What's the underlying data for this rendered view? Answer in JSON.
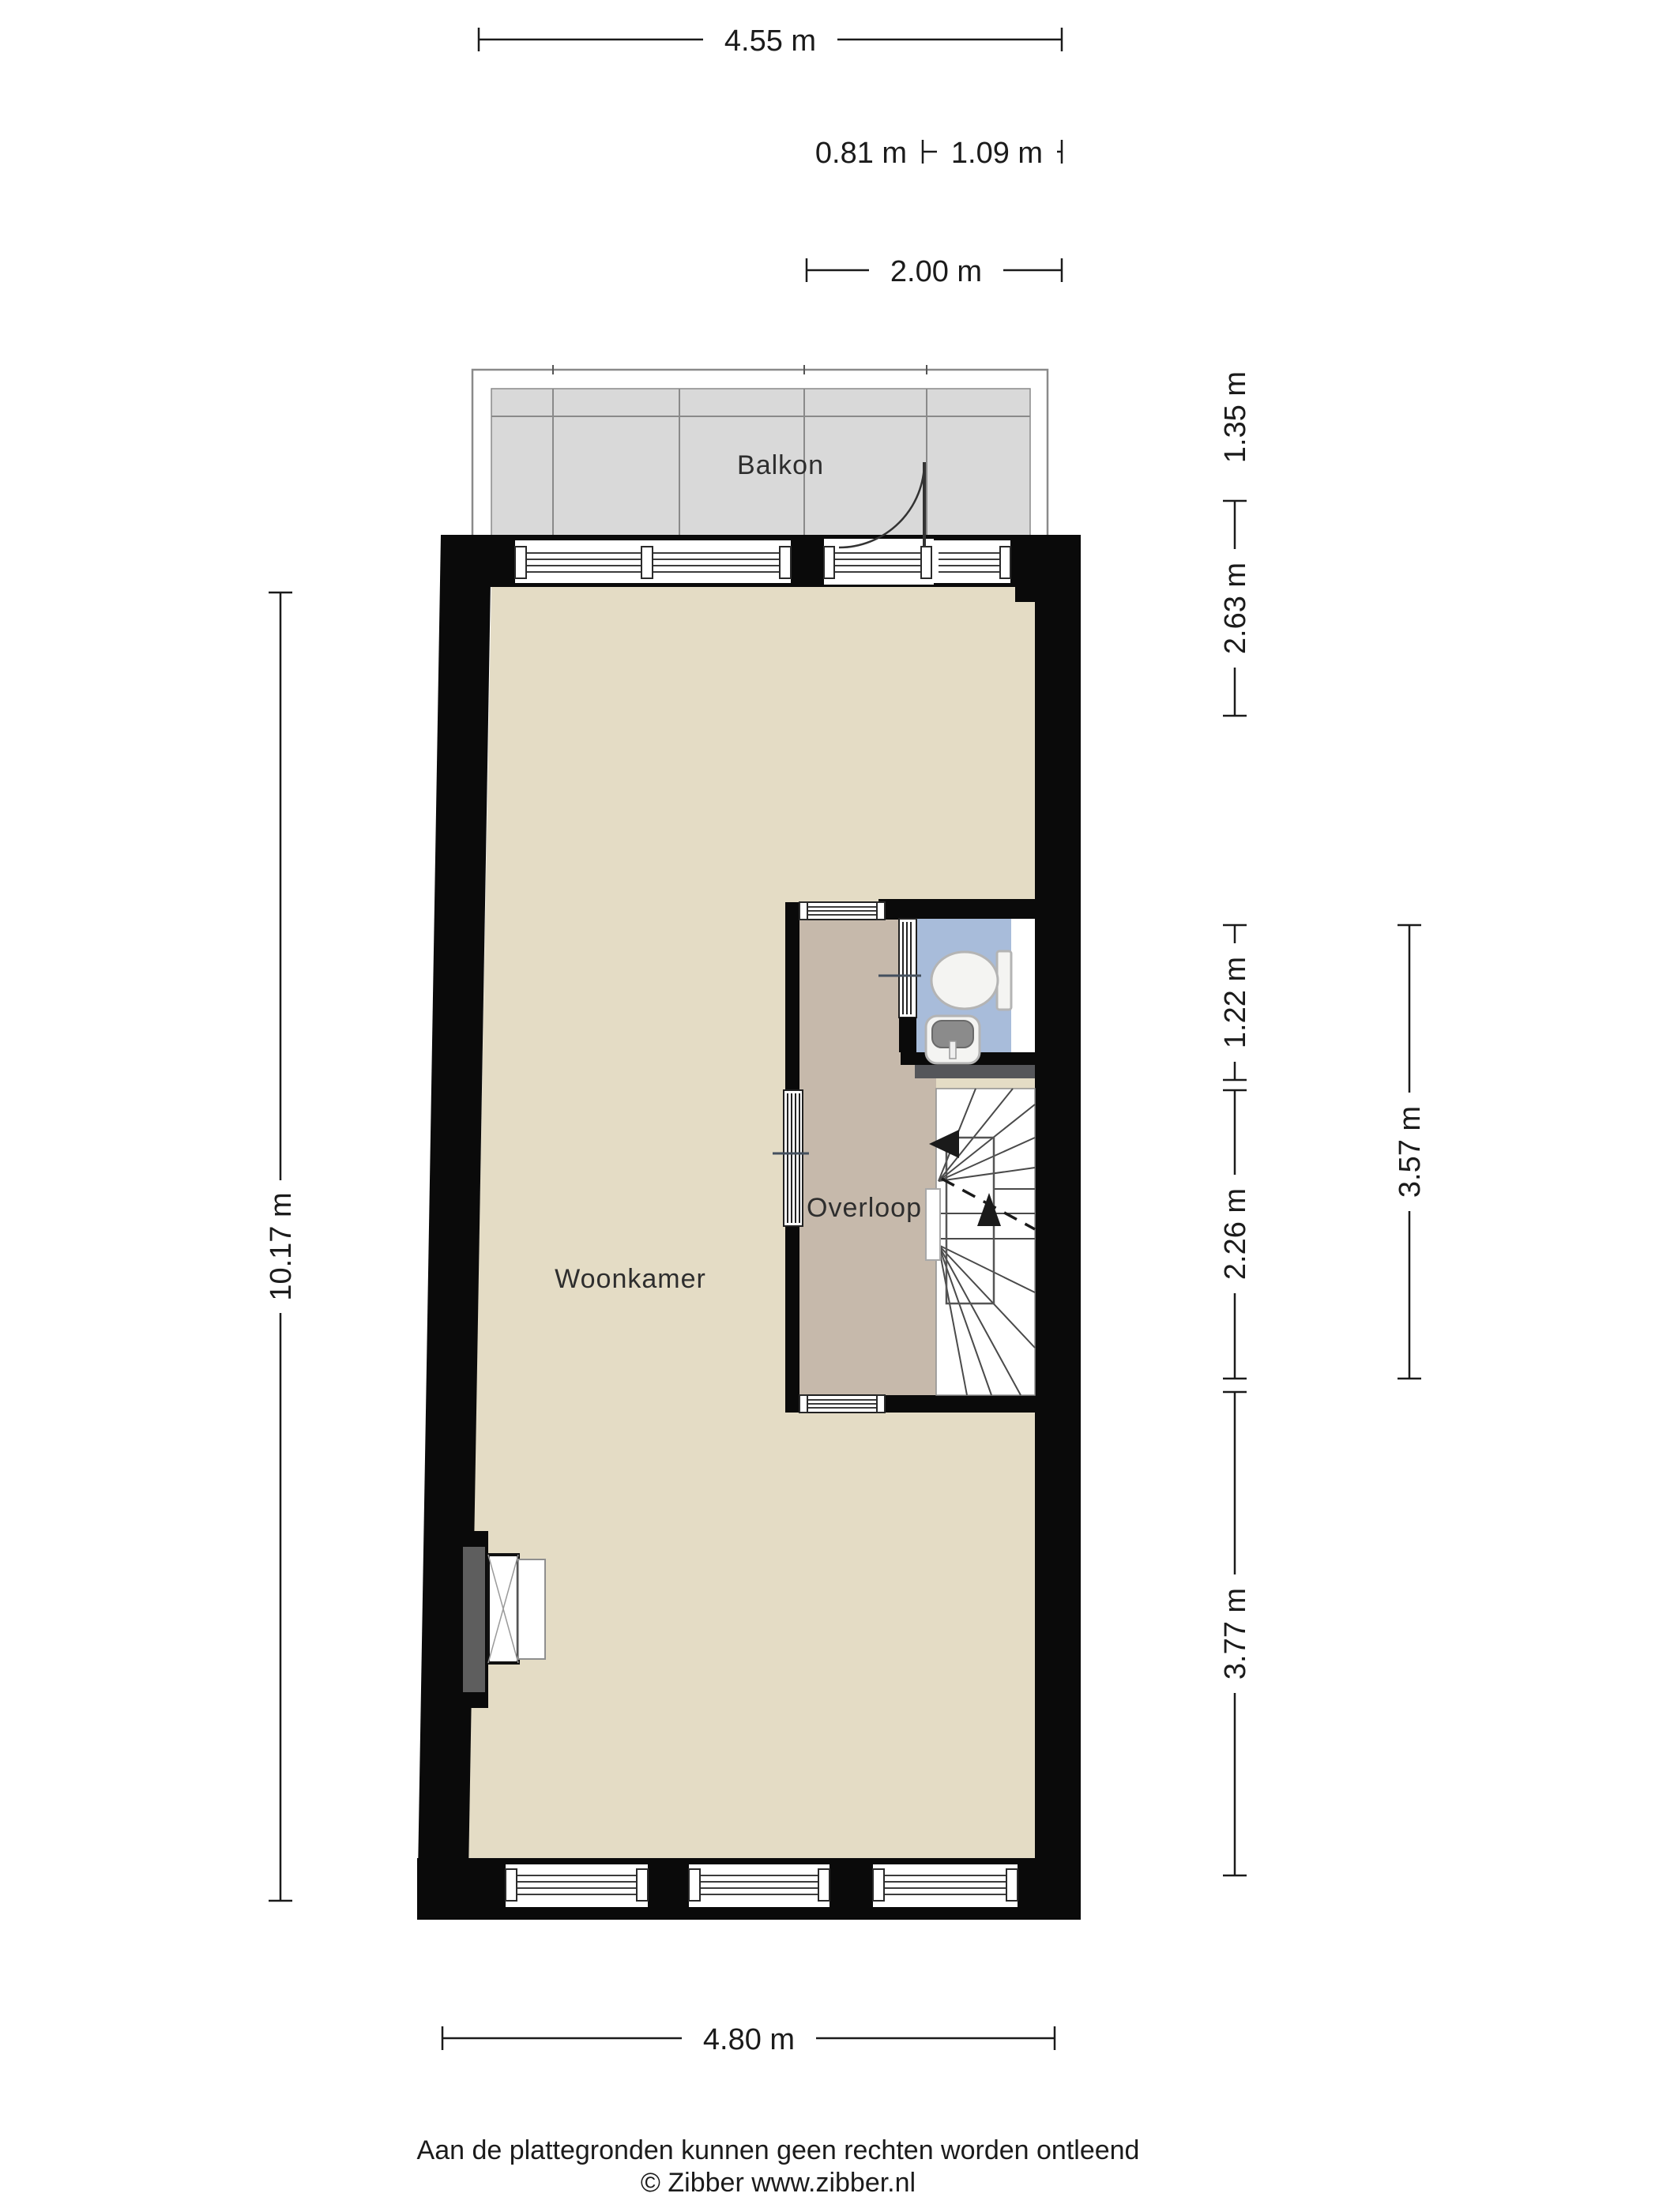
{
  "rooms": {
    "balcony": {
      "label": "Balkon"
    },
    "living": {
      "label": "Woonkamer"
    },
    "landing": {
      "label": "Overloop"
    }
  },
  "dimensions": {
    "top_width": "4.55 m",
    "balcony_door_offset": "0.81 m",
    "balcony_door_width": "1.09 m",
    "balcony_width": "2.00 m",
    "balcony_depth": "1.35 m",
    "living_top_height": "2.63 m",
    "toilet_height": "1.22 m",
    "stairs_height": "2.26 m",
    "living_bottom_height": "3.77 m",
    "block_height": "3.57 m",
    "left_height": "10.17 m",
    "bottom_width": "4.80 m"
  },
  "footer": {
    "disclaimer": "Aan de plattegronden kunnen geen rechten worden ontleend",
    "copyright": "© Zibber www.zibber.nl"
  },
  "colors": {
    "wall": "#0a0a0a",
    "living_floor": "#e4dcc5",
    "landing_floor": "#c6b9ab",
    "toilet_floor": "#a8bcda",
    "balcony_floor": "#d9d9d9",
    "step_bar": "#55565a",
    "chimney": "#5e5e5e",
    "annotation": "#1b1b1b"
  }
}
